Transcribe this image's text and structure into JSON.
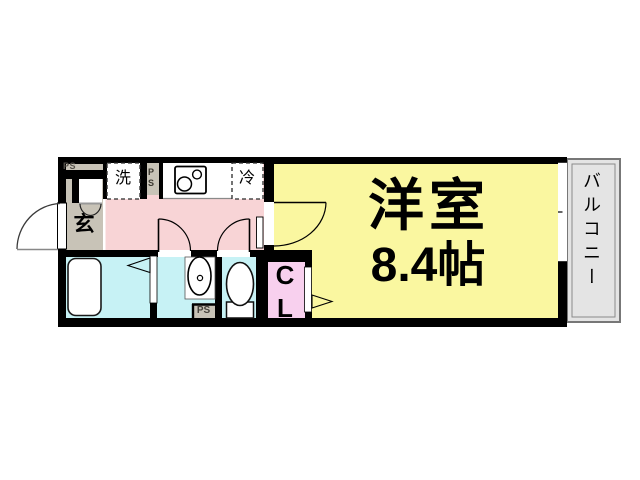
{
  "floorplan": {
    "rooms": {
      "main_room": {
        "name": "洋室",
        "size": "8.4帖"
      },
      "entrance": {
        "label": "玄"
      },
      "balcony": {
        "label": "バルコニー"
      },
      "closet": {
        "label": "CL"
      }
    },
    "fixtures": {
      "washer_label": "洗",
      "fridge_label": "冷"
    },
    "pipe_spaces": {
      "entrance": "PS",
      "kitchen": "PS",
      "lavatory": "PS"
    },
    "colors": {
      "wall": "#000000",
      "kitchen_pink": "#f8d4d6",
      "room_yellow": "#faf7a0",
      "wet_cyan": "#c7f2f5",
      "closet_pink": "#f8d0ee",
      "entrance_gray": "#c8c3b7",
      "balcony_gray": "#e4e4e4",
      "balcony_border": "#7a7a7a"
    }
  }
}
